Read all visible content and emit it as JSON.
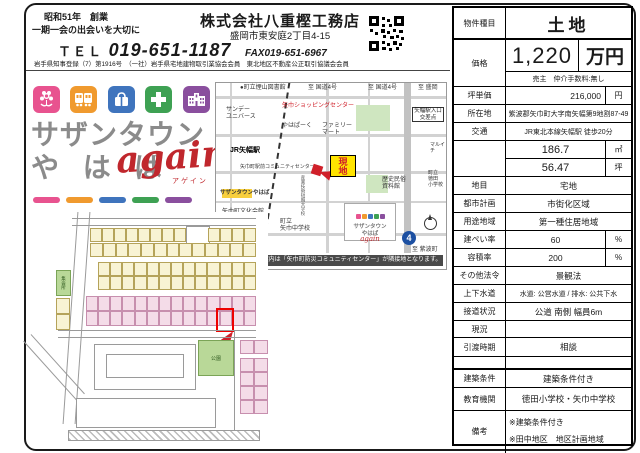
{
  "header": {
    "founded": "昭和51年　創業",
    "slogan": "一期一会の出会いを大切に",
    "company": "株式会社八重樫工務店",
    "address": "盛岡市東安庭2丁目4-15",
    "tel_label": "ＴＥＬ",
    "tel": "019-651-1187",
    "fax": "FAX019-651-6967",
    "license": "岩手県知事登録（7）第1916号　（一社）岩手県宅地建物取引業協会会員　東北地区不動産公正取引協議会会員",
    "qr_icon": "qr-code-icon"
  },
  "logo": {
    "line1": "サザンタウン",
    "line2": "や は ば",
    "script": "again",
    "script_kana": "アゲイン",
    "icons": [
      "flower-icon",
      "train-icon",
      "bag-icon",
      "medical-cross-icon",
      "school-icon"
    ],
    "colors": {
      "pink": "#e8538f",
      "orange": "#f09a2e",
      "blue": "#3f74bd",
      "green": "#3ea153",
      "purple": "#8a4f9e"
    }
  },
  "map": {
    "labels": {
      "library": "●町立煙山図書館",
      "to_route4_a": "至 国道4号",
      "to_route4_b": "至 国道4号",
      "to_morioka": "至 盛岡",
      "sunday": "サンデー\nユニバース",
      "shopping": "矢巾ショッピングセンター",
      "crossing": "矢幅駅入口\n交差点",
      "yahapark": "やはぱーく",
      "familymart": "ファミリー\nマート",
      "station": "JR矢幅駅",
      "community": "矢巾町駅前コミュニティセンター",
      "southern": "サザンタウンやはば",
      "genchi": "現\n地",
      "museum": "歴史民俗\n資料館",
      "tokuda_es": "町立\n徳田\n小学校",
      "maruichi": "マルイチ",
      "univ": "産業技術短期大学校",
      "bunkakaikan": "矢巾町文化会館\n(田園ホール)",
      "junior_high": "町立\n矢巾中学校",
      "mini_logo_text": "サザンタウン\nやはば",
      "mini_logo_script": "again",
      "route4": "4",
      "to_shiwa": "至 紫波町"
    },
    "caption": "カーナビでのご案内は「矢巾町防災コミュニティセンター」が隣接地となります。"
  },
  "plat": {
    "park": "公園",
    "hall": "集会所"
  },
  "property": {
    "type": {
      "label": "物件種目",
      "value": "土地"
    },
    "price": {
      "label": "価格",
      "value": "1,220",
      "unit": "万円",
      "note": "売主　仲介手数料:無し"
    },
    "unit_price": {
      "label": "坪単価",
      "value": "216,000",
      "unit": "円"
    },
    "location": {
      "label": "所在地",
      "value": "紫波郡矢巾町大字南矢幅第9地割87-49"
    },
    "access": {
      "label": "交通",
      "value": "JR東北本線矢幅駅 徒歩20分"
    },
    "area": {
      "label": "",
      "sqm": "186.7",
      "sqm_unit": "㎡",
      "tsubo": "56.47",
      "tsubo_unit": "坪"
    },
    "land_category": {
      "label": "地目",
      "value": "宅地"
    },
    "city_planning": {
      "label": "都市計画",
      "value": "市街化区域"
    },
    "zoning": {
      "label": "用途地域",
      "value": "第一種住居地域"
    },
    "coverage": {
      "label": "建ぺい率",
      "value": "60",
      "unit": "%"
    },
    "floor_ratio": {
      "label": "容積率",
      "value": "200",
      "unit": "%"
    },
    "other_laws": {
      "label": "その他法令",
      "value": "景観法"
    },
    "water": {
      "label": "上下水道",
      "value": "水道: 公営水道 / 排水: 公共下水"
    },
    "road": {
      "label": "接道状況",
      "value": "公道 南側 幅員6m"
    },
    "current_state": {
      "label": "現況",
      "value": ""
    },
    "delivery": {
      "label": "引渡時期",
      "value": "相談"
    },
    "building_condition": {
      "label": "建築条件",
      "value": "建築条件付き"
    },
    "schools": {
      "label": "教育機関",
      "value": "徳田小学校・矢巾中学校"
    },
    "remarks": {
      "label": "備考",
      "line1": "※建築条件付き",
      "line2": "※田中地区　地区計画地域"
    }
  }
}
